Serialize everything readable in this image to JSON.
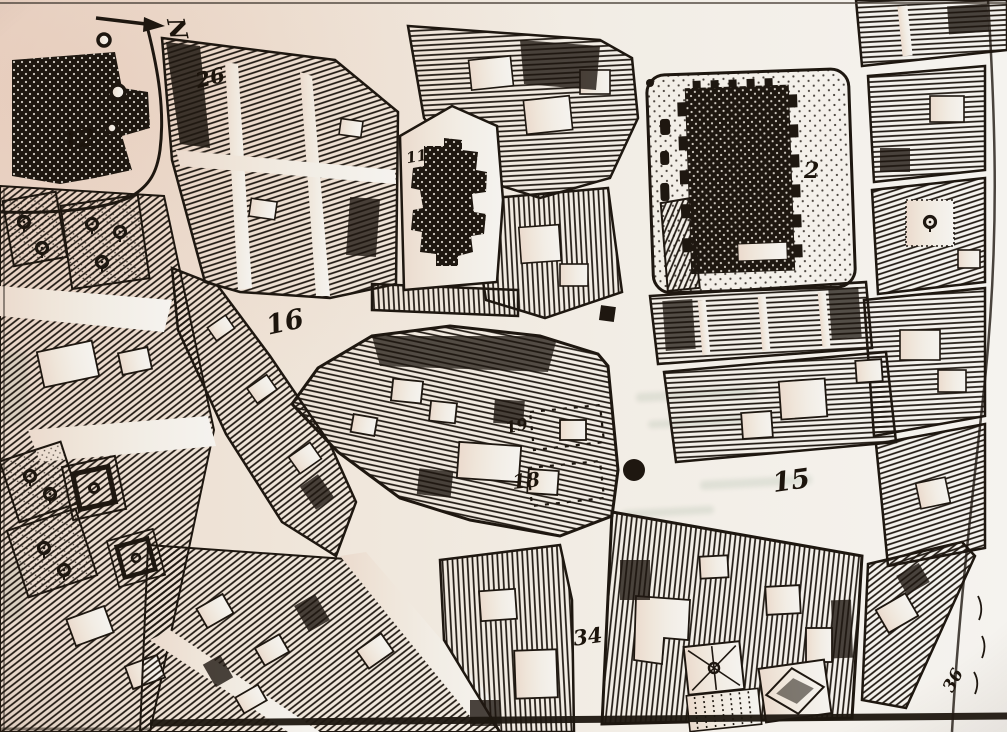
{
  "meta": {
    "description": "Photographed book plate: detail of an early-modern engraved city map with numbered sites, hatched building blocks, churches, garden plots and market stalls",
    "media": "scanned print, black ink on aged paper"
  },
  "palette": {
    "ink": "#1e1710",
    "paper": "#f2ece3",
    "paper_warm_left": "#ecdccf",
    "paper_cool_right": "#f4f2ee",
    "bleedthrough": "#8aa08a"
  },
  "compass": {
    "letter": "N",
    "direction": "arrow points right toward rotated letter N"
  },
  "labels": [
    {
      "id": "block-26",
      "text": "26"
    },
    {
      "id": "site-12",
      "text": "12"
    },
    {
      "id": "church-11",
      "text": "11"
    },
    {
      "id": "church-2",
      "text": "2"
    },
    {
      "id": "street-16",
      "text": "16"
    },
    {
      "id": "stalls-19",
      "text": "19"
    },
    {
      "id": "stalls-18",
      "text": "18"
    },
    {
      "id": "street-15",
      "text": "15"
    },
    {
      "id": "street-34",
      "text": "34"
    },
    {
      "id": "street-36",
      "text": "36"
    }
  ],
  "markers": [
    {
      "name": "standard-square-marker",
      "shape": "small solid square in street"
    },
    {
      "name": "conduit-dot-marker",
      "shape": "solid round dot in street"
    },
    {
      "name": "market-stall-outlines",
      "shape": "two dashed rectangles"
    }
  ],
  "features": [
    "stippled church with buttresses (2) inside walled churchyard",
    "cross-shaped stippled church (11) inside yard",
    "solid stippled building (12) with curved precinct wall and tree roundels",
    "dense hatched housing blocks with white courtyards",
    "formal square garden parterres and tree orchards on west side",
    "radiating-path garden, diamond parterre and planted rows at bottom",
    "wide unnamed streets labelled 15, 16, 34, 36"
  ]
}
